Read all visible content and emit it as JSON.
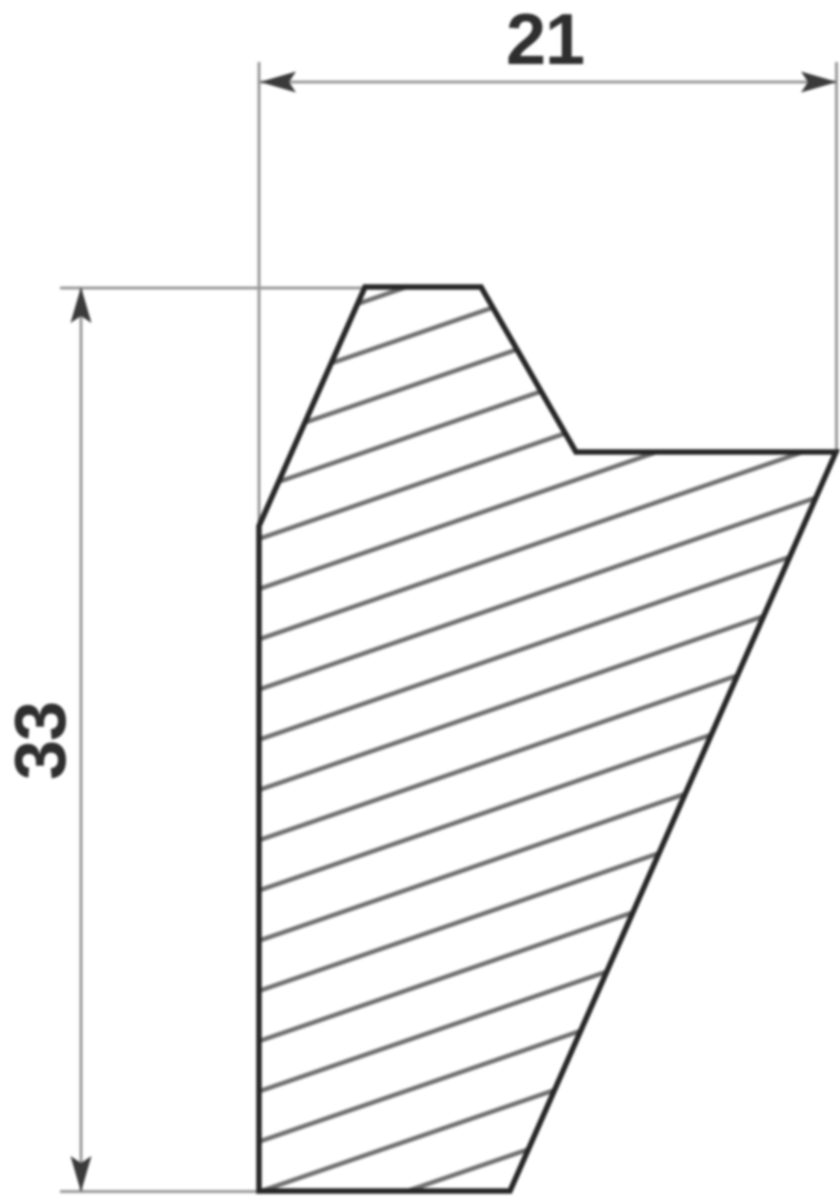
{
  "drawing": {
    "dimension_width": {
      "label": "21"
    },
    "dimension_height": {
      "label": "33"
    },
    "colors": {
      "background": "#ffffff",
      "outline": "#262626",
      "hatch": "#6f6f6f",
      "dimension_line": "#9a9a9a",
      "arrow": "#3a3a3a",
      "text": "#2e2e2e"
    }
  }
}
